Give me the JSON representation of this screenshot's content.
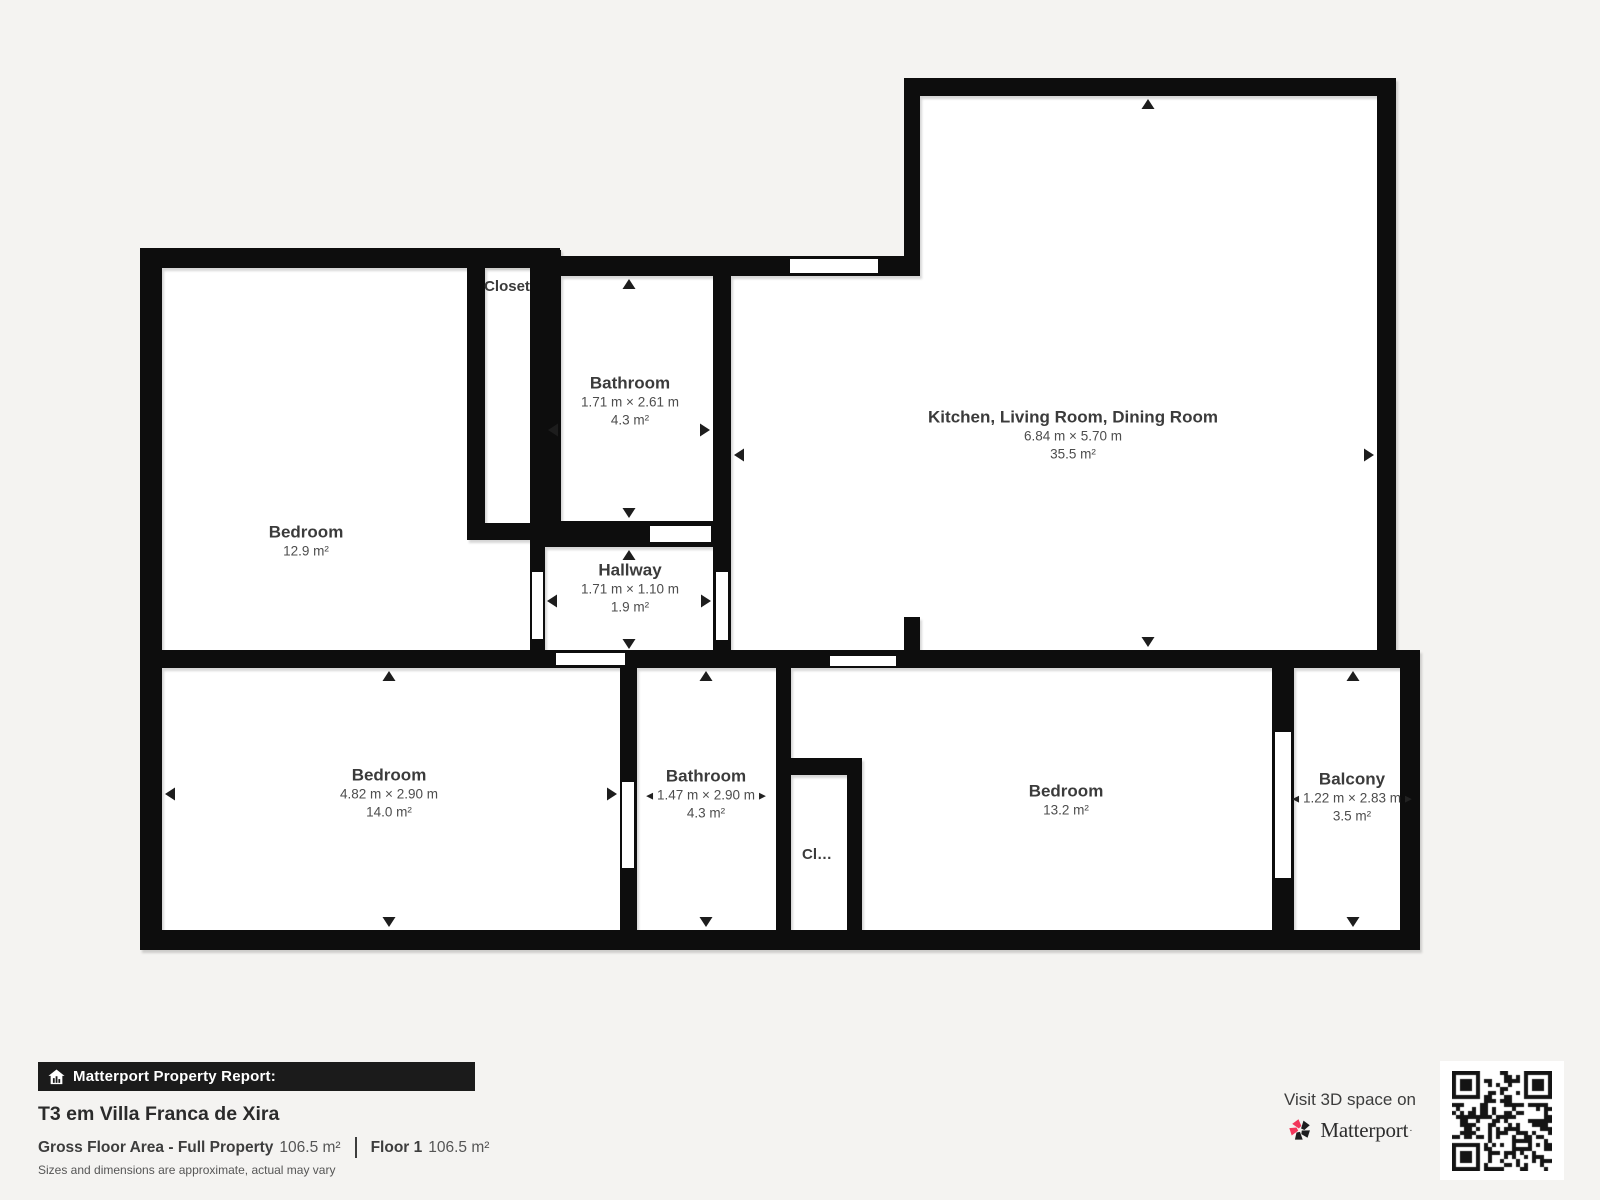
{
  "colors": {
    "background": "#f4f3f1",
    "wall": "#0c0c0c",
    "room_fill": "#ffffff",
    "brand_pink": "#f2365b",
    "bar_background": "#1b1b1b"
  },
  "icons": {
    "arrow_left": "◀",
    "arrow_right": "▶"
  },
  "plan": {
    "rooms": [
      {
        "id": "bedroom1",
        "name": "Bedroom",
        "area": "12.9 m²"
      },
      {
        "id": "closet1",
        "name": "Closet"
      },
      {
        "id": "bathroom1",
        "name": "Bathroom",
        "dims": "1.71 m × 2.61 m",
        "area": "4.3 m²"
      },
      {
        "id": "hallway",
        "name": "Hallway",
        "dims": "1.71 m × 1.10 m",
        "area": "1.9 m²"
      },
      {
        "id": "kitchen",
        "name": "Kitchen, Living Room, Dining Room",
        "dims": "6.84 m × 5.70 m",
        "area": "35.5 m²"
      },
      {
        "id": "bedroom2",
        "name": "Bedroom",
        "dims": "4.82 m × 2.90 m",
        "area": "14.0 m²"
      },
      {
        "id": "bathroom2",
        "name": "Bathroom",
        "dims": "1.47 m × 2.90 m",
        "area": "4.3 m²"
      },
      {
        "id": "closet2",
        "name": "Cl…"
      },
      {
        "id": "bedroom3",
        "name": "Bedroom",
        "area": "13.2 m²"
      },
      {
        "id": "balcony",
        "name": "Balcony",
        "dims": "1.22 m × 2.83 m",
        "area": "3.5 m²"
      }
    ]
  },
  "report": {
    "bar_label": "Matterport Property Report:",
    "title": "T3 em Villa Franca de Xira",
    "gross_label": "Gross Floor Area - Full Property",
    "gross_value": "106.5 m²",
    "floor_label": "Floor 1",
    "floor_value": "106.5 m²",
    "disclaimer": "Sizes and dimensions are approximate, actual may vary"
  },
  "promo": {
    "visit_text": "Visit 3D space on",
    "brand": "Matterport",
    "brand_mark": "·"
  }
}
